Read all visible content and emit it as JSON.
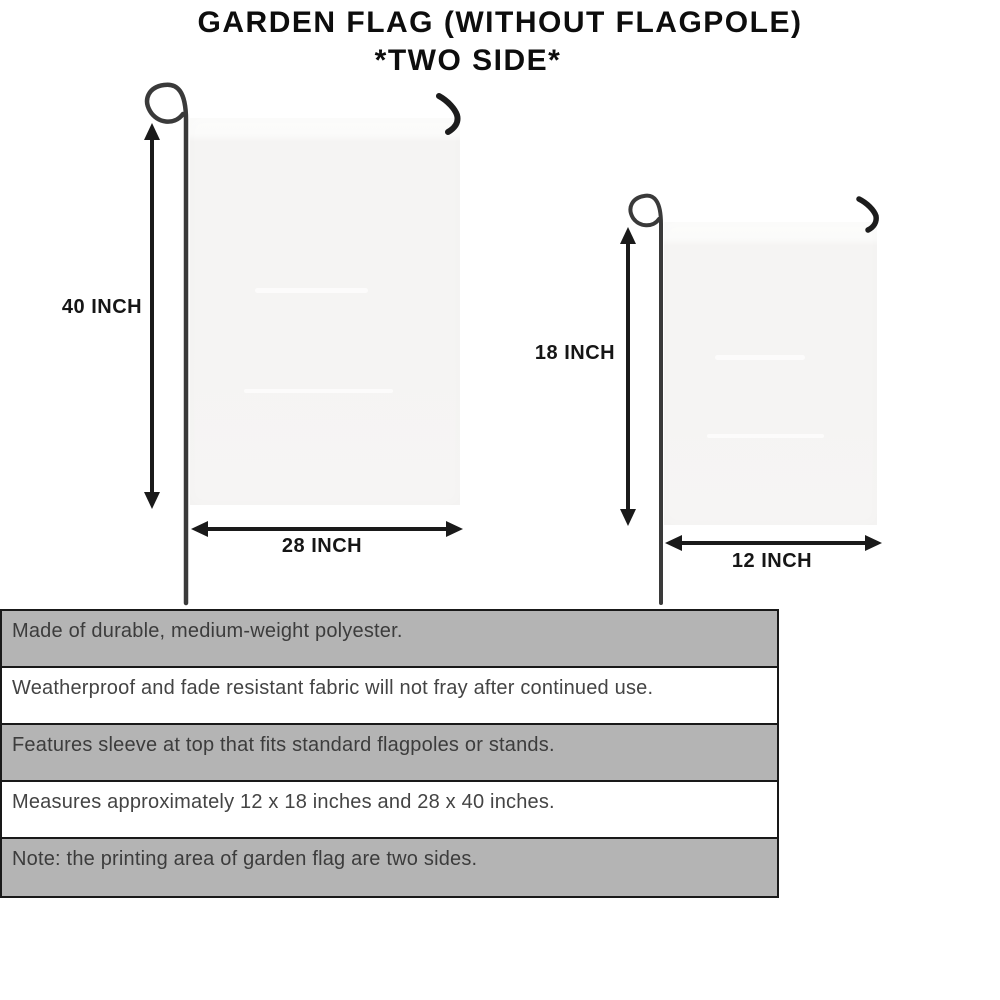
{
  "title": {
    "line1": "GARDEN FLAG (WITHOUT FLAGPOLE)",
    "line2": "*TWO SIDE*"
  },
  "diagram": {
    "large_flag": {
      "height_label": "40 INCH",
      "width_label": "28 INCH"
    },
    "small_flag": {
      "height_label": "18 INCH",
      "width_label": "12 INCH"
    }
  },
  "features": [
    {
      "text": "Made of durable, medium-weight polyester.",
      "shaded": true
    },
    {
      "text": "Weatherproof and fade resistant fabric will not fray after continued use.",
      "shaded": false
    },
    {
      "text": "Features sleeve at top that fits standard flagpoles or stands.",
      "shaded": true
    },
    {
      "text": "Measures approximately 12 x 18 inches and 28 x 40 inches.",
      "shaded": false
    },
    {
      "text": "Note: the printing area of garden flag are two sides.",
      "shaded": true
    }
  ],
  "colors": {
    "table_row_shaded": "#b4b4b4",
    "table_row_plain": "#ffffff",
    "table_border": "#191919",
    "flag_fill": "#f5f4f3",
    "pole": "#3a3a3a",
    "arrow": "#1a1a1a",
    "title_text": "#0d0d0d",
    "feature_text": "#3c3c3c"
  }
}
